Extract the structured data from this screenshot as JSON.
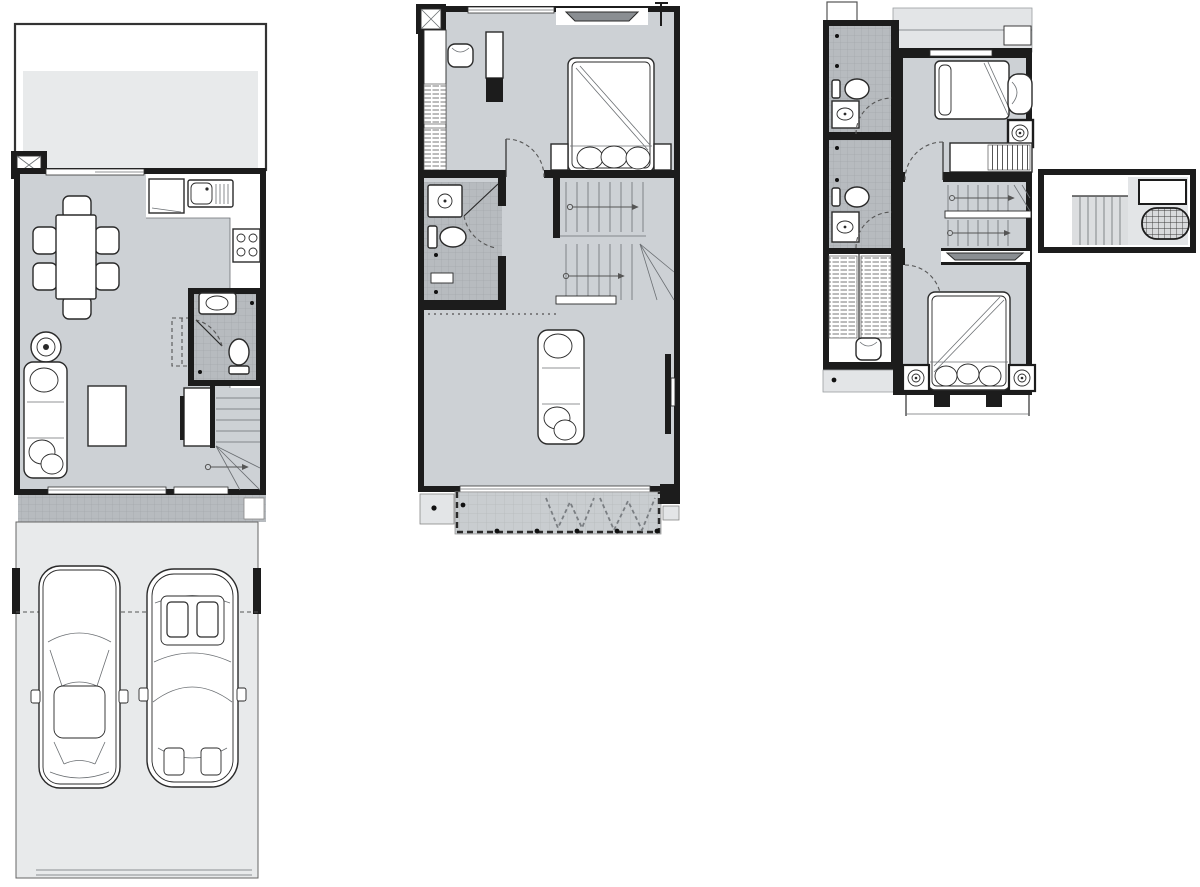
{
  "title": "townhouse-three-storey-floor-plans",
  "colors": {
    "wall": "#1c1c1c",
    "ink": "#2a2a2a",
    "floor": "#cdd1d5",
    "tile": "#b7bbbf",
    "tileline": "#a4a8ac",
    "yard": "#e8eaeb",
    "balcony": "#c9cdd0",
    "ledge": "#e3e5e7",
    "acgray": "#8a8e92",
    "stairfill": "#dcdee0",
    "paper": "#ffffff"
  },
  "plans": [
    {
      "name": "first-floor-plan",
      "rooms": [
        "front-yard",
        "dining-area",
        "kitchen",
        "bathroom",
        "living-area",
        "staircase",
        "rear-porch",
        "carport-driveway"
      ],
      "furniture": [
        "column-marker",
        "dining-table",
        "dining-chair-x6",
        "refrigerator",
        "kitchen-sink",
        "cooktop-4-burner",
        "round-side-table",
        "sofa-3-seat",
        "coffee-table",
        "tv-cabinet",
        "wash-basin",
        "toilet",
        "winder-stair-with-arrow",
        "sedan-car-top-view",
        "sports-car-top-view"
      ]
    },
    {
      "name": "second-floor-plan",
      "rooms": [
        "bedroom",
        "closet-strip",
        "bathroom",
        "staircase",
        "living-room",
        "balcony-terrace"
      ],
      "furniture": [
        "column-marker",
        "antenna-mark",
        "air-conditioner",
        "double-bed",
        "nightstand-x2",
        "armchair",
        "wardrobe-cabinet",
        "shower",
        "toilet",
        "floor-drain-x2",
        "u-stair-with-arrows",
        "sofa-3-seat",
        "wall-tv",
        "condenser-ledge",
        "railing-dashed",
        "planter-shrubs"
      ]
    },
    {
      "name": "third-floor-plan",
      "rooms": [
        "bathroom-1",
        "bathroom-2",
        "closet",
        "bedroom-2",
        "stair-hall",
        "master-bedroom",
        "exterior-ledge"
      ],
      "furniture": [
        "toilet-x2",
        "wash-basin-x2",
        "floor-drain-x4",
        "shelf-hatch-closet",
        "desk-chair",
        "single-bed",
        "lounge-chair",
        "washing-machine",
        "wardrobe-rail",
        "u-stair-with-arrows",
        "air-conditioner",
        "double-bed",
        "speaker-nightstand-x2",
        "window-mullions"
      ]
    },
    {
      "name": "roof-plan",
      "rooms": [
        "stair-bulkhead",
        "tank-deck"
      ],
      "furniture": [
        "stair-treads",
        "equipment-box",
        "water-tank-grated"
      ]
    }
  ]
}
